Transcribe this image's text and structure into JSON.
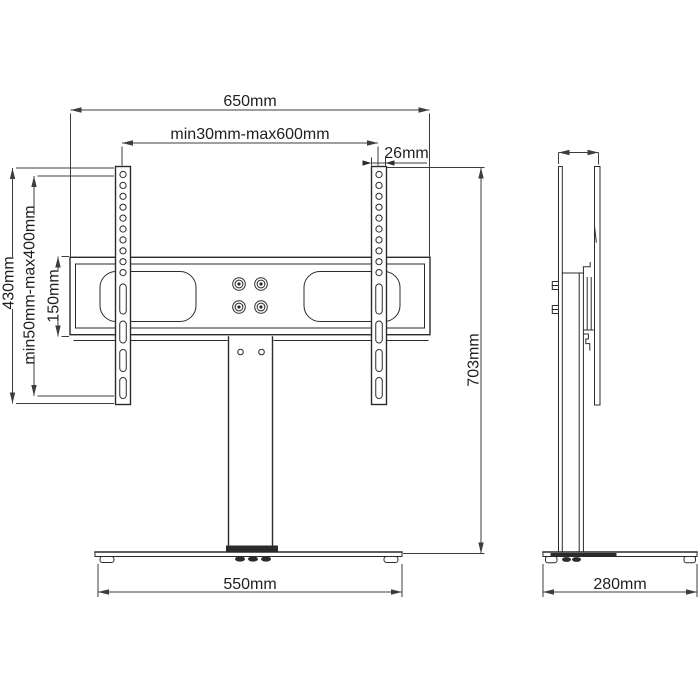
{
  "drawing": {
    "colors": {
      "line": "#2b2b2b",
      "dim": "#3d3d3d",
      "text": "#1f1f1f",
      "bg": "#ffffff"
    },
    "front_view": {
      "total_width": "650mm",
      "hole_span": "min30mm-max600mm",
      "rail_width": "26mm",
      "rail_height": "430mm",
      "vesa_vertical": "min50mm-max400mm",
      "bar_height": "150mm",
      "base_width": "550mm",
      "total_height": "703mm"
    },
    "side_view": {
      "base_depth": "280mm"
    }
  }
}
